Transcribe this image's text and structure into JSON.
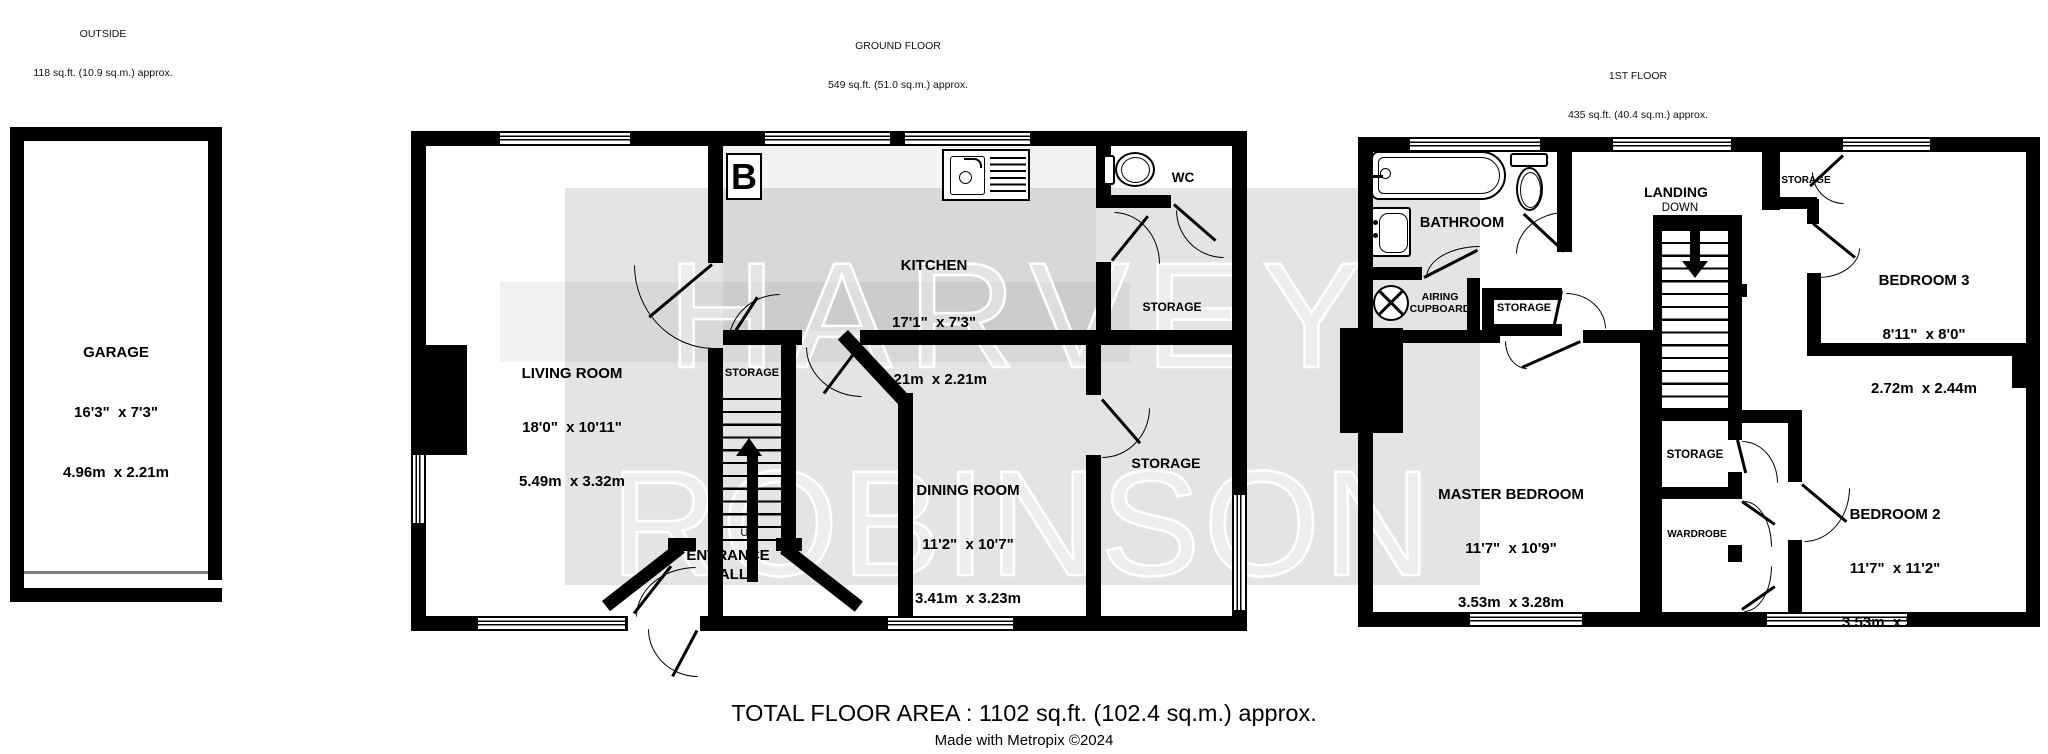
{
  "floors": {
    "outside": {
      "title": "OUTSIDE",
      "area": "118 sq.ft. (10.9 sq.m.) approx."
    },
    "ground": {
      "title": "GROUND FLOOR",
      "area": "549 sq.ft. (51.0 sq.m.) approx."
    },
    "first": {
      "title": "1ST FLOOR",
      "area": "435 sq.ft. (40.4 sq.m.) approx."
    }
  },
  "rooms": {
    "garage": {
      "name": "GARAGE",
      "imperial": "16'3\"  x 7'3\"",
      "metric": "4.96m  x 2.21m"
    },
    "living": {
      "name": "LIVING ROOM",
      "imperial": "18'0\"  x 10'11\"",
      "metric": "5.49m  x 3.32m"
    },
    "kitchen": {
      "name": "KITCHEN",
      "imperial": "17'1\"  x 7'3\"",
      "metric": "5.21m  x 2.21m"
    },
    "dining": {
      "name": "DINING ROOM",
      "imperial": "11'2\"  x 10'7\"",
      "metric": "3.41m  x 3.23m"
    },
    "master": {
      "name": "MASTER BEDROOM",
      "imperial": "11'7\"  x 10'9\"",
      "metric": "3.53m  x 3.28m"
    },
    "bedroom2": {
      "name": "BEDROOM 2",
      "imperial": "11'7\"  x 11'2\"",
      "metric": "3.53m  x 3.40m"
    },
    "bedroom3": {
      "name": "BEDROOM 3",
      "imperial": "8'11\"  x 8'0\"",
      "metric": "2.72m  x 2.44m"
    }
  },
  "labels": {
    "storage": "STORAGE",
    "wc": "WC",
    "bathroom": "BATHROOM",
    "landing": "LANDING",
    "down": "DOWN",
    "up": "UP",
    "entrance_hall": "ENTRANCE HALL",
    "airing_cupboard": "AIRING CUPBOARD",
    "wardrobe": "WARDROBE",
    "boiler": "B"
  },
  "watermark": {
    "line1": "HARVEY",
    "line2": "ROBINSON"
  },
  "footer": {
    "total_area": "TOTAL FLOOR AREA : 1102 sq.ft. (102.4 sq.m.) approx.",
    "credit": "Made with Metropix ©2024"
  },
  "colors": {
    "wall": "#000000",
    "watermark_band": "#e3e3e3",
    "kitchen_floor": "#e8e8e8"
  }
}
